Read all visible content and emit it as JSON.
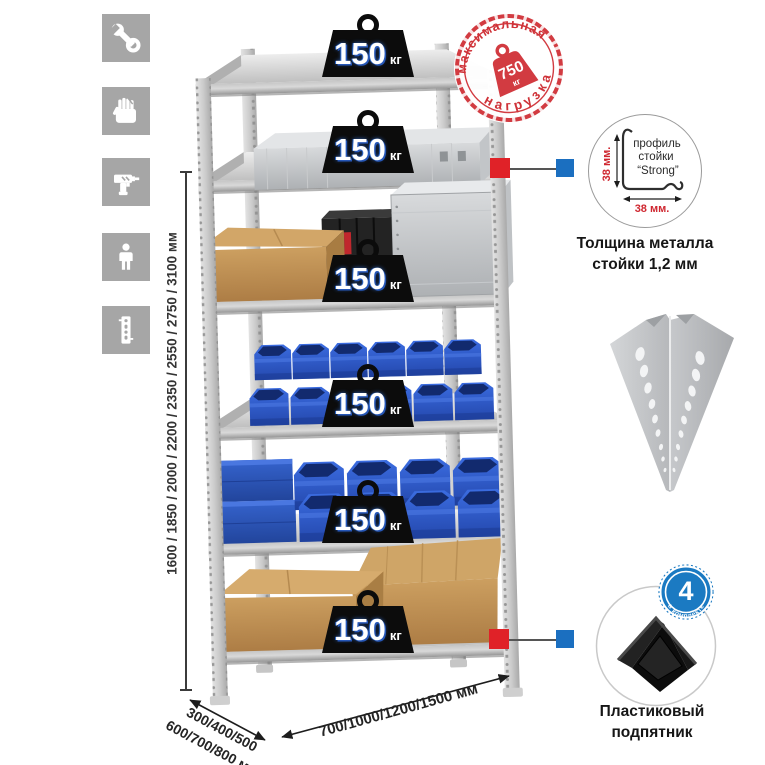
{
  "left_toolbar": {
    "icons": [
      {
        "name": "wrench-icon"
      },
      {
        "name": "gloves-icon"
      },
      {
        "name": "drill-icon"
      },
      {
        "name": "person-icon"
      },
      {
        "name": "post-profile-icon"
      }
    ]
  },
  "rack": {
    "shelves": [
      {
        "load": "150",
        "unit": "кг"
      },
      {
        "load": "150",
        "unit": "кг"
      },
      {
        "load": "150",
        "unit": "кг"
      },
      {
        "load": "150",
        "unit": "кг"
      },
      {
        "load": "150",
        "unit": "кг"
      },
      {
        "load": "150",
        "unit": "кг"
      }
    ]
  },
  "max_load_stamp": {
    "arc_top": "максимальная",
    "arc_bottom": "нагрузка",
    "value": "750",
    "unit": "кг"
  },
  "dimensions": {
    "height_label": "1600 / 1850 / 2000 / 2200 / 2350 / 2550 / 2750 / 3100 мм",
    "depth_label_line1": "300/400/500",
    "depth_label_line2": "600/700/800 мм",
    "width_label": "700/1000/1200/1500 мм"
  },
  "profile_detail": {
    "line1": "профиль",
    "line2": "стойки",
    "line3": "“Strong”",
    "dim_vertical": "38 мм.",
    "dim_horizontal": "38 мм.",
    "caption_line1": "Толщина металла",
    "caption_line2": "стойки 1,2 мм"
  },
  "foot_detail": {
    "badge_value": "4",
    "badge_arc": "в комплекте",
    "caption_line1": "Пластиковый",
    "caption_line2": "подпятник"
  },
  "colors": {
    "accent_red": "#e02228",
    "accent_blue": "#1b6fc0",
    "stamp_red": "#d23b41",
    "bin_blue": "#2a55bd",
    "icon_gray": "#a6a6a6"
  }
}
